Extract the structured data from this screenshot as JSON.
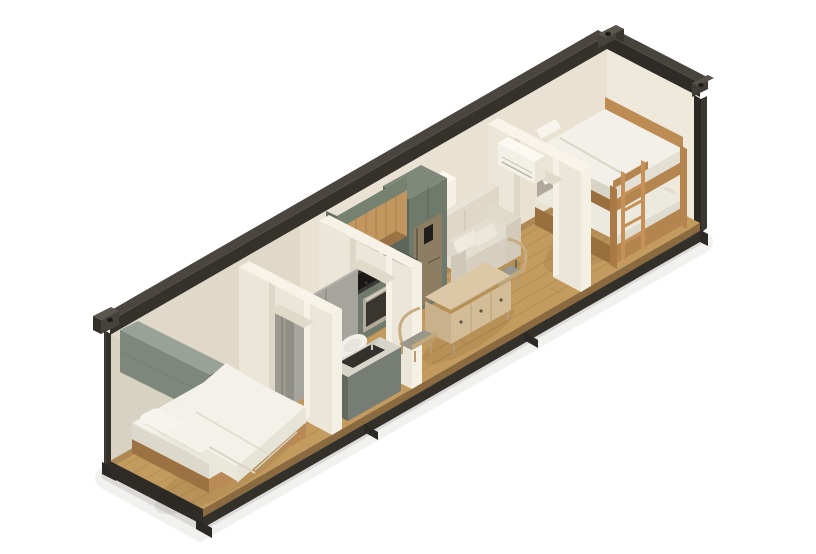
{
  "meta": {
    "title": "Isometric cutaway rendering of a shipping-container tiny home",
    "render_style": "3D isometric architectural cutaway",
    "background": "#ffffff"
  },
  "palette": {
    "frame_dark": "#35322c",
    "frame_mid": "#4a463f",
    "frame_deep": "#2b2825",
    "wall_back": "#e9e2d3",
    "wall_end_right": "#efe9dc",
    "wall_end_left": "#d8d2c3",
    "partition": "#ece6d8",
    "partition_light": "#f5f0e4",
    "floor_wood": "#c49b5e",
    "floor_edge": "#8a6a3e",
    "plank_line": "#a8813f",
    "sage_cabinet": "#6f7a6d",
    "sage_dark": "#5c675b",
    "sage_wall_cabinet": "#7d877c",
    "timber_cabinet": "#c1975f",
    "timber_dark": "#9d7243",
    "bunk_timber": "#b5854f",
    "bed_timber": "#b98a55",
    "bedding_white": "#f2f0e8",
    "linen": "#e3ddcf",
    "sofa_base": "#d6cfc0",
    "counter_dark": "#3a3935",
    "steel_oven": "#b3ab9c",
    "fridge_bronze": "#8d7d62",
    "cushion_gray": "#9b968b",
    "table_wood": "#dcc8a6",
    "ac_white": "#f3f0e8",
    "door_leaf_gray": "#9c9a90",
    "shower_gray": "#a5a49d",
    "basin_dark": "#33312c",
    "toilet_white": "#f0efe9"
  },
  "scene": {
    "structure": [
      "dark steel container frame with corner castings",
      "open cutaway front and top",
      "oak plank flooring",
      "cream interior walls"
    ],
    "rooms": [
      {
        "name": "bedroom",
        "position": "left end",
        "furniture": [
          "double bed with white duvet and two pillows",
          "sage wall-mounted storage cabinet"
        ]
      },
      {
        "name": "bathroom",
        "position": "left-center",
        "furniture": [
          "gray shower enclosure",
          "toilet",
          "gray vanity with dark sink",
          "sliding door"
        ]
      },
      {
        "name": "kitchen",
        "position": "center",
        "furniture": [
          "timber upper cabinets",
          "sage base cabinets",
          "black cooktop",
          "built-in oven",
          "bronze refrigerator",
          "tall pantry unit",
          "small white wall box"
        ]
      },
      {
        "name": "living-dining",
        "position": "right-center",
        "furniture": [
          "cream two-seat sofa with pillows",
          "drop-leaf dining table with drawers",
          "two timber chairs"
        ]
      },
      {
        "name": "bunk-room",
        "position": "right end",
        "furniture": [
          "timber bunk bed with ladder",
          "air-conditioner above doorway"
        ]
      }
    ]
  }
}
